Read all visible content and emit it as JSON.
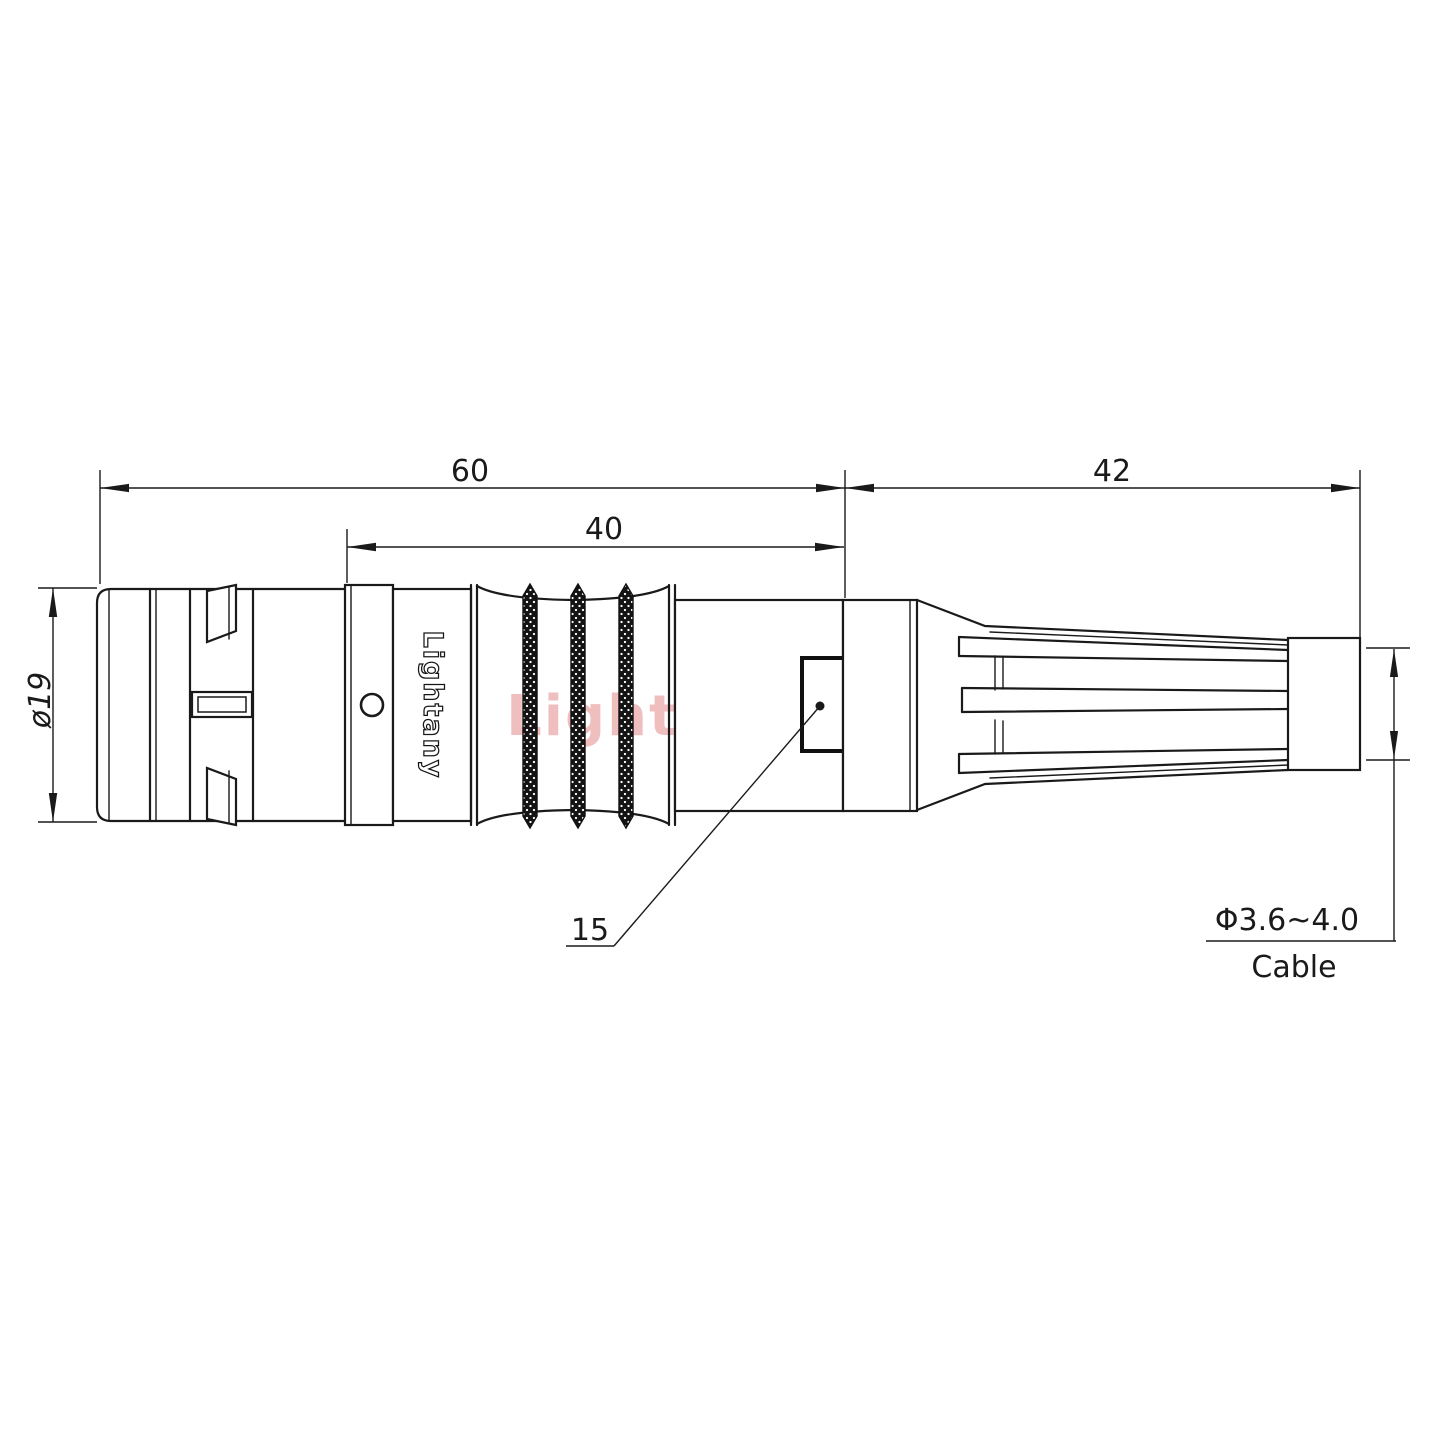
{
  "meta": {
    "type": "connector-technical-drawing",
    "units_scale": "60mm-main-body / 42mm-strain-relief",
    "colors": {
      "background": "#ffffff",
      "line": "#1a1a1a",
      "watermark": "#e08080"
    }
  },
  "branding": {
    "engraving": "Lightany",
    "watermark": "Lightany"
  },
  "dims": {
    "overall": "60",
    "mid": "40",
    "relief": "42",
    "diameter": "ø19",
    "feature": "15",
    "cable_range": "Φ3.6~4.0",
    "cable_word": "Cable"
  }
}
